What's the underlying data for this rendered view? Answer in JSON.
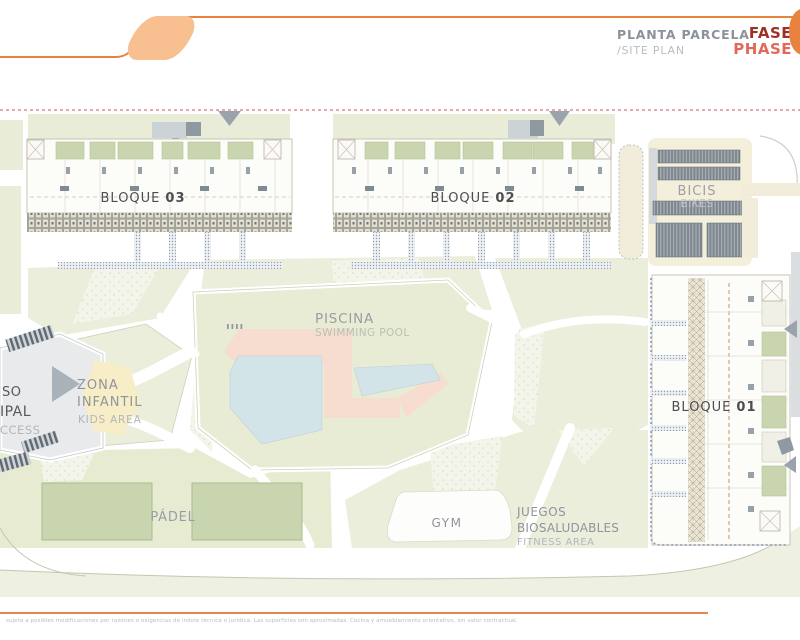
{
  "header": {
    "title_primary": "PLANTA PARCELA",
    "title_secondary": "/SITE PLAN",
    "phase_label_es": "FASE",
    "phase_label_en": "PHASE",
    "phase_number": "0"
  },
  "site_plan": {
    "blocks": [
      {
        "name": "BLOQUE",
        "number": "03"
      },
      {
        "name": "BLOQUE",
        "number": "02"
      },
      {
        "name": "BLOQUE",
        "number": "01"
      }
    ],
    "areas": {
      "pool": {
        "label_es": "PISCINA",
        "label_en": "SWIMMING POOL"
      },
      "kids": {
        "label_es_line1": "ZONA",
        "label_es_line2": "INFANTIL",
        "label_en": "KIDS AREA"
      },
      "padel": {
        "label": "PÁDEL"
      },
      "gym": {
        "label": "GYM"
      },
      "fitness": {
        "label_es_line1": "JUEGOS",
        "label_es_line2": "BIOSALUDABLES",
        "label_en": "FITNESS AREA"
      },
      "bikes": {
        "label_es": "BICIS",
        "label_en": "BIKES"
      },
      "access": {
        "fragment_line1": "SO",
        "fragment_line2": "IPAL",
        "fragment_line3": "CCESS"
      }
    }
  },
  "footer": {
    "disclaimer": "sujeta a posibles modificaciones por razones o exigencias de índole técnica o jurídica. Las superficies son aproximadas. Cocina y amueblamiento orientativo, sin valor contractual."
  },
  "colors": {
    "accent_orange": "#e8833c",
    "logo_fill": "#f8c091",
    "phase_dark_red": "#9d2f24",
    "phase_salmon": "#e2695a",
    "boundary_dash_red": "#c4595c",
    "green_base": "#eaeedb",
    "court_green": "#c8d5af",
    "pool_blue": "#d3e4e9",
    "deck_pink": "#f7ddcf",
    "kids_yellow": "#f7edc6",
    "bikes_cream": "#f4efdb",
    "label_gray": "#8f959c",
    "label_light": "#b2b7bd"
  }
}
